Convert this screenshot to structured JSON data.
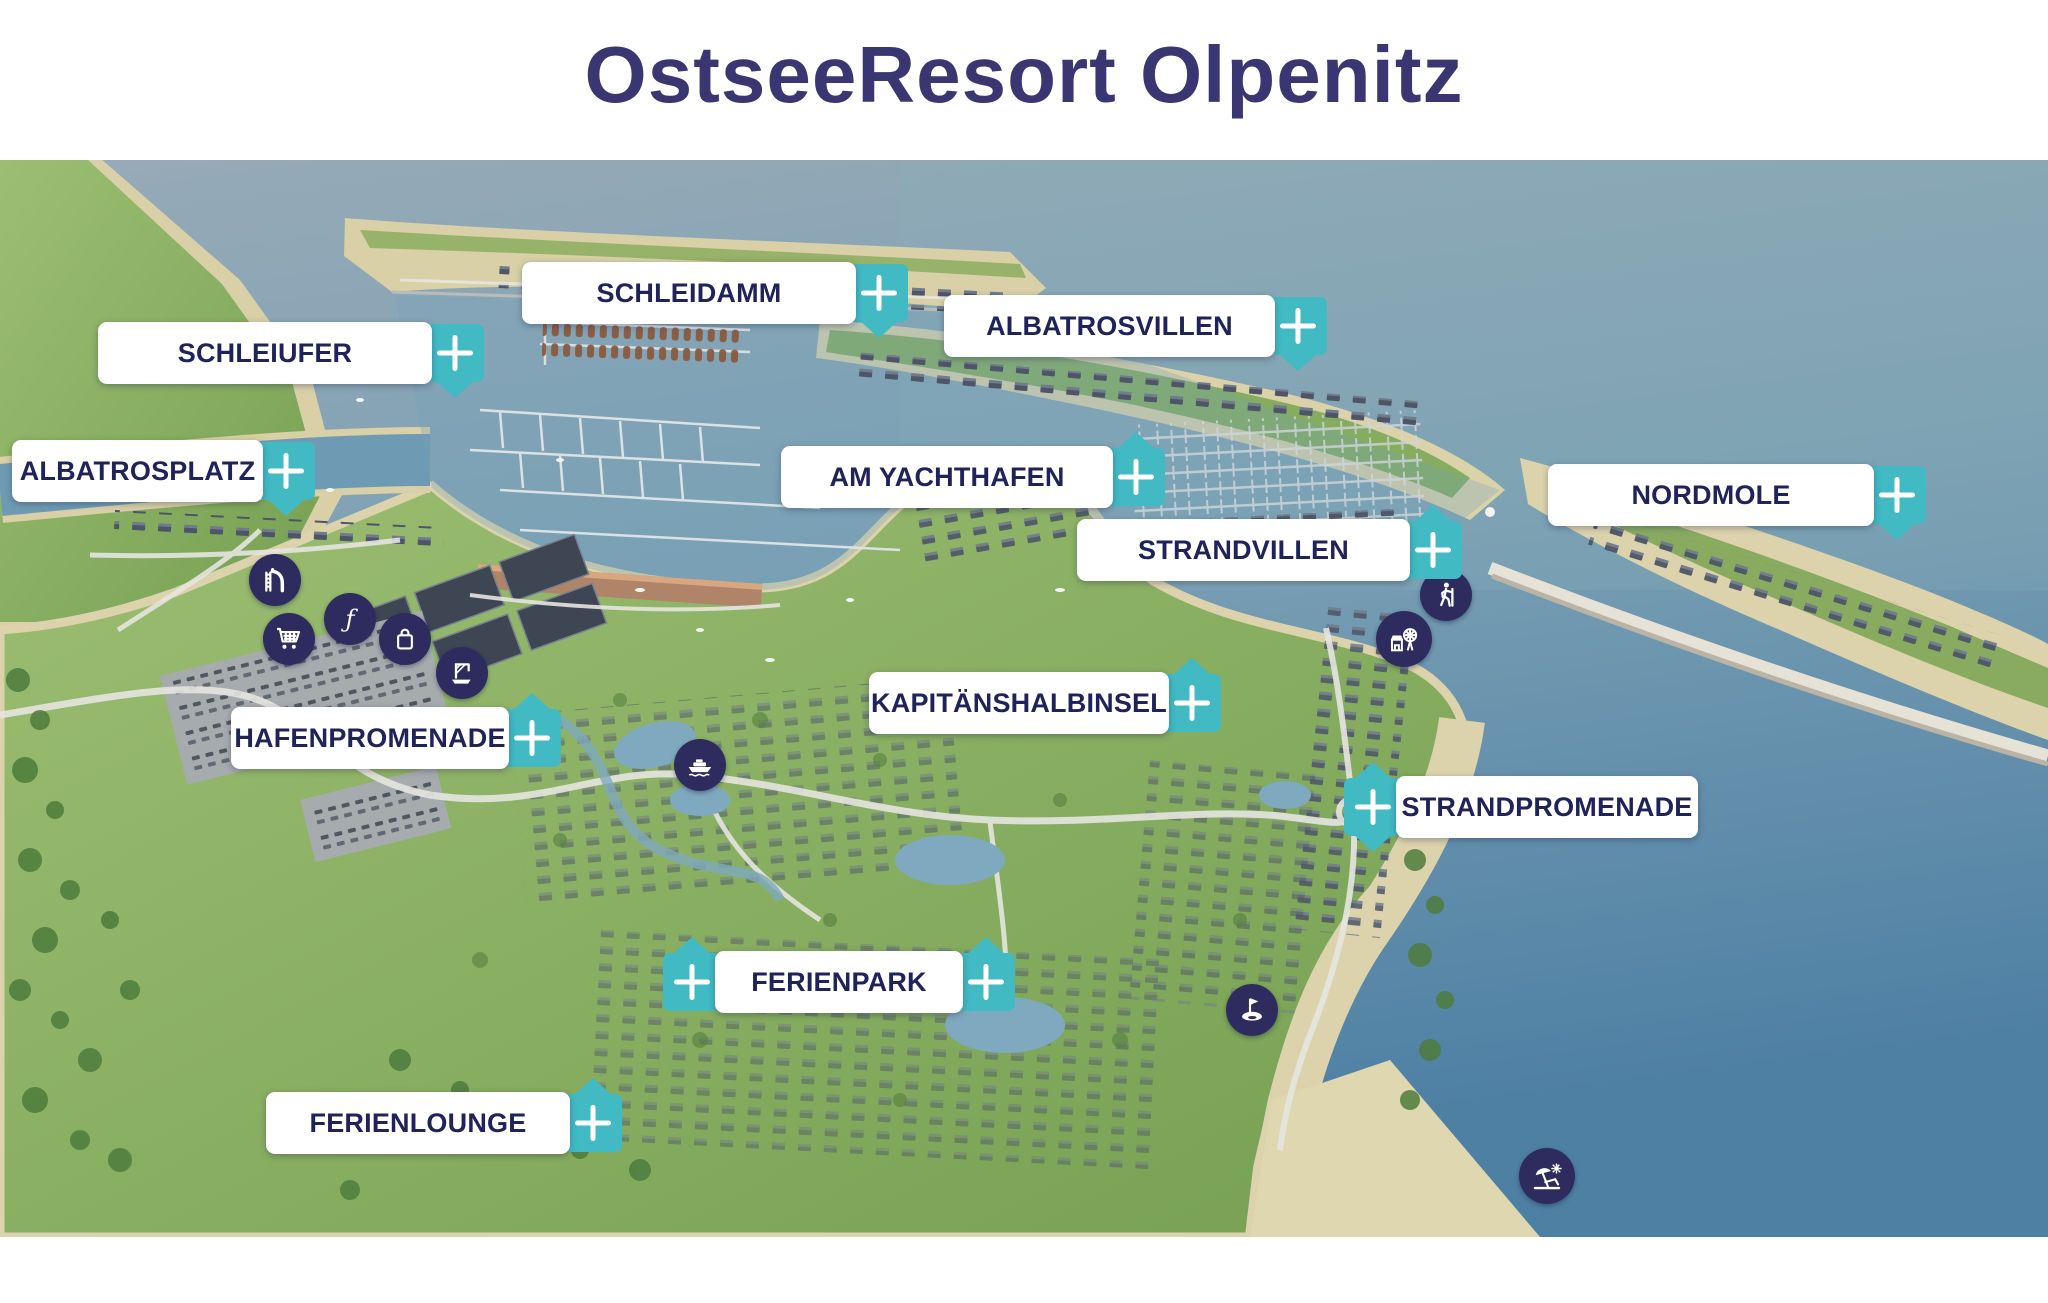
{
  "title": "OstseeResort Olpenitz",
  "theme": {
    "title_color": "#3A3671",
    "label_text_color": "#20235A",
    "label_bg": "#FFFFFF",
    "plus_button_bg": "#41BAC4",
    "plus_glyph": "+",
    "poi_circle_bg": "#2E2C5E",
    "poi_glyph_color": "#FFFFFF"
  },
  "map": {
    "markers": [
      {
        "label": "SCHLEIDAMM",
        "plus_side": "right",
        "tail": "down"
      },
      {
        "label": "SCHLEIUFER",
        "plus_side": "right",
        "tail": "down"
      },
      {
        "label": "ALBATROSVILLEN",
        "plus_side": "right",
        "tail": "down"
      },
      {
        "label": "ALBATROSPLATZ",
        "plus_side": "right",
        "tail": "down"
      },
      {
        "label": "AM YACHTHAFEN",
        "plus_side": "right",
        "tail": "up"
      },
      {
        "label": "NORDMOLE",
        "plus_side": "right",
        "tail": "down"
      },
      {
        "label": "STRANDVILLEN",
        "plus_side": "right",
        "tail": "up"
      },
      {
        "label": "KAPITÄNSHALBINSEL",
        "plus_side": "right",
        "tail": "up"
      },
      {
        "label": "HAFENPROMENADE",
        "plus_side": "right",
        "tail": "up"
      },
      {
        "label": "STRANDPROMENADE",
        "plus_side": "left",
        "tail": "both"
      },
      {
        "label": "FERIENPARK",
        "plus_side": "both",
        "tail": "up"
      },
      {
        "label": "FERIENLOUNGE",
        "plus_side": "right",
        "tail": "up"
      }
    ],
    "icons": [
      {
        "name": "water-slide"
      },
      {
        "name": "shopping-cart"
      },
      {
        "name": "f-logo"
      },
      {
        "name": "shopping-bag"
      },
      {
        "name": "boat-crane"
      },
      {
        "name": "ferry"
      },
      {
        "name": "hiking"
      },
      {
        "name": "beach-market"
      },
      {
        "name": "golf"
      },
      {
        "name": "beach"
      }
    ]
  }
}
